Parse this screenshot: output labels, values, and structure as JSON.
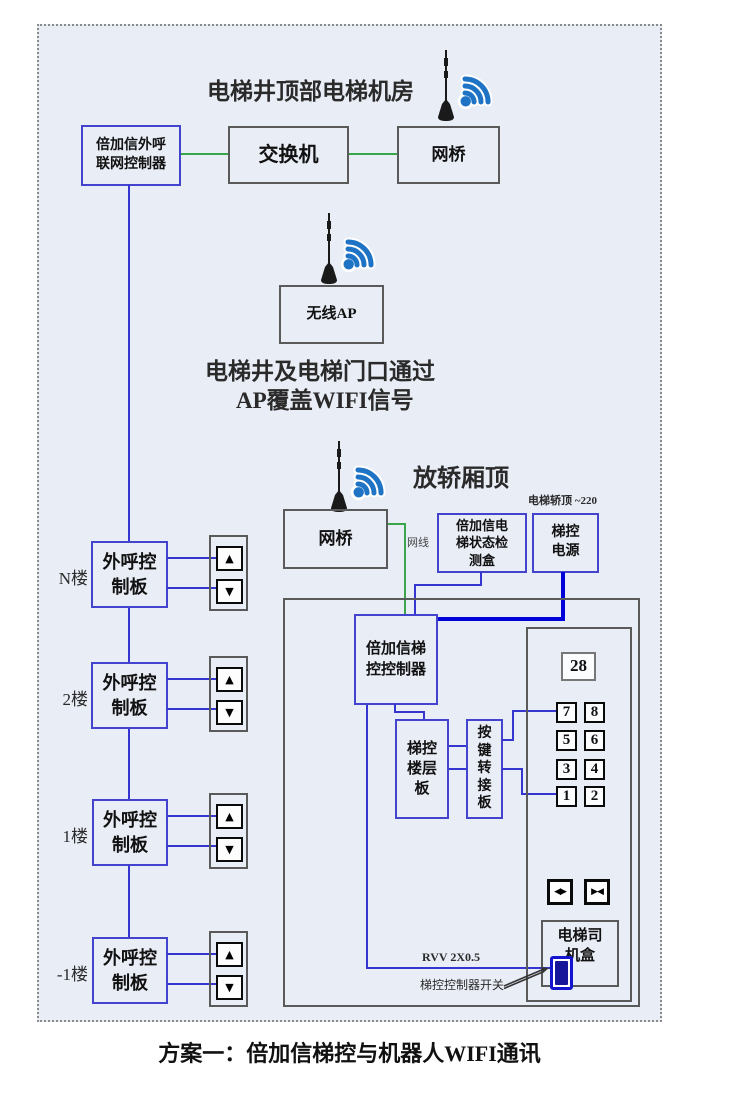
{
  "caption": "方案一：倍加信梯控与机器人WIFI通讯",
  "machine_room": {
    "title": "电梯井顶部电梯机房",
    "call_controller": "倍加信外呼\n联网控制器",
    "switch": "交换机",
    "bridge": "网桥"
  },
  "ap": {
    "box": "无线AP",
    "note1": "电梯井及电梯门口通过",
    "note2": "AP覆盖WIFI信号"
  },
  "car_roof": {
    "title": "放轿厢顶",
    "power_note": "电梯轿顶 ~220",
    "cable_label": "网线",
    "bridge": "网桥",
    "status_box": "倍加信电\n梯状态检\n测盒",
    "power_box": "梯控\n电源",
    "controller": "倍加信梯\n控控制器",
    "floor_board": "梯控\n楼层\n板",
    "key_board": "按\n键\n转\n接\n板",
    "rvv_label": "RVV 2X0.5",
    "switch_label": "梯控控制器开关"
  },
  "panel": {
    "display": "28",
    "buttons": [
      "7",
      "8",
      "5",
      "6",
      "3",
      "4",
      "1",
      "2"
    ],
    "door_open": "◀▶",
    "door_close": "▶◀",
    "driver_box": "电梯司\n机盒"
  },
  "floors": [
    {
      "label": "N楼",
      "board": "外呼控\n制板"
    },
    {
      "label": "2楼",
      "board": "外呼控\n制板"
    },
    {
      "label": "1楼",
      "board": "外呼控\n制板"
    },
    {
      "label": "-1楼",
      "board": "外呼控\n制板"
    }
  ],
  "icons": {
    "up": "▲",
    "down": "▼"
  },
  "colors": {
    "diagram_bg": "#e9edf6",
    "blue_box": "#4343cd",
    "gray_box": "#5a5a5a",
    "line_blue": "#3535cf",
    "line_green": "#3aa54a",
    "line_power": "#0000d8",
    "wifi_blue": "#1e73c4"
  }
}
